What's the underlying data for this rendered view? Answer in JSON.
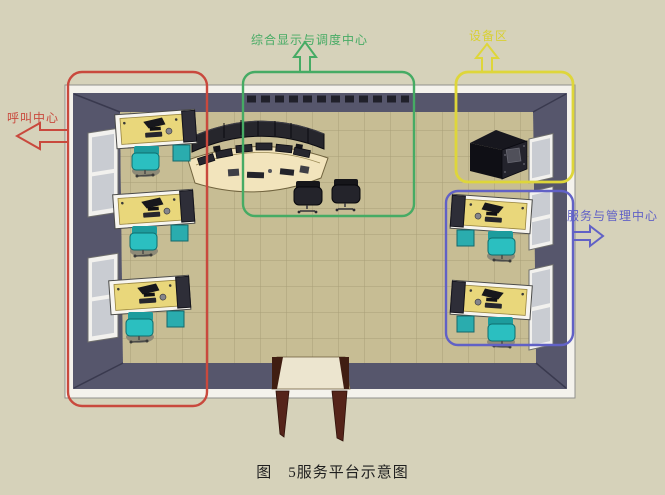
{
  "figure": {
    "caption": "图　5服务平台示意图"
  },
  "zones": {
    "call_center": {
      "label": "呼叫中心",
      "color": "#c9493d",
      "side": "left"
    },
    "display_dispatch_center": {
      "label": "综合显示与调度中心",
      "color": "#46ab64",
      "side": "top-center"
    },
    "equipment_area": {
      "label": "设备区",
      "color": "#ded63a",
      "side": "top-right"
    },
    "service_management_center": {
      "label": "服务与管理中心",
      "color": "#6161c6",
      "side": "right"
    }
  },
  "room": {
    "wall_color": "#56566c",
    "floor_color": "#c7bd94",
    "frame_color": "#f4f2ec",
    "background_color": "#d6d2ba",
    "furniture": {
      "left_workstations": 3,
      "right_workstations": 2,
      "console_operator_chairs": 2,
      "server_cabinets": 1
    }
  }
}
